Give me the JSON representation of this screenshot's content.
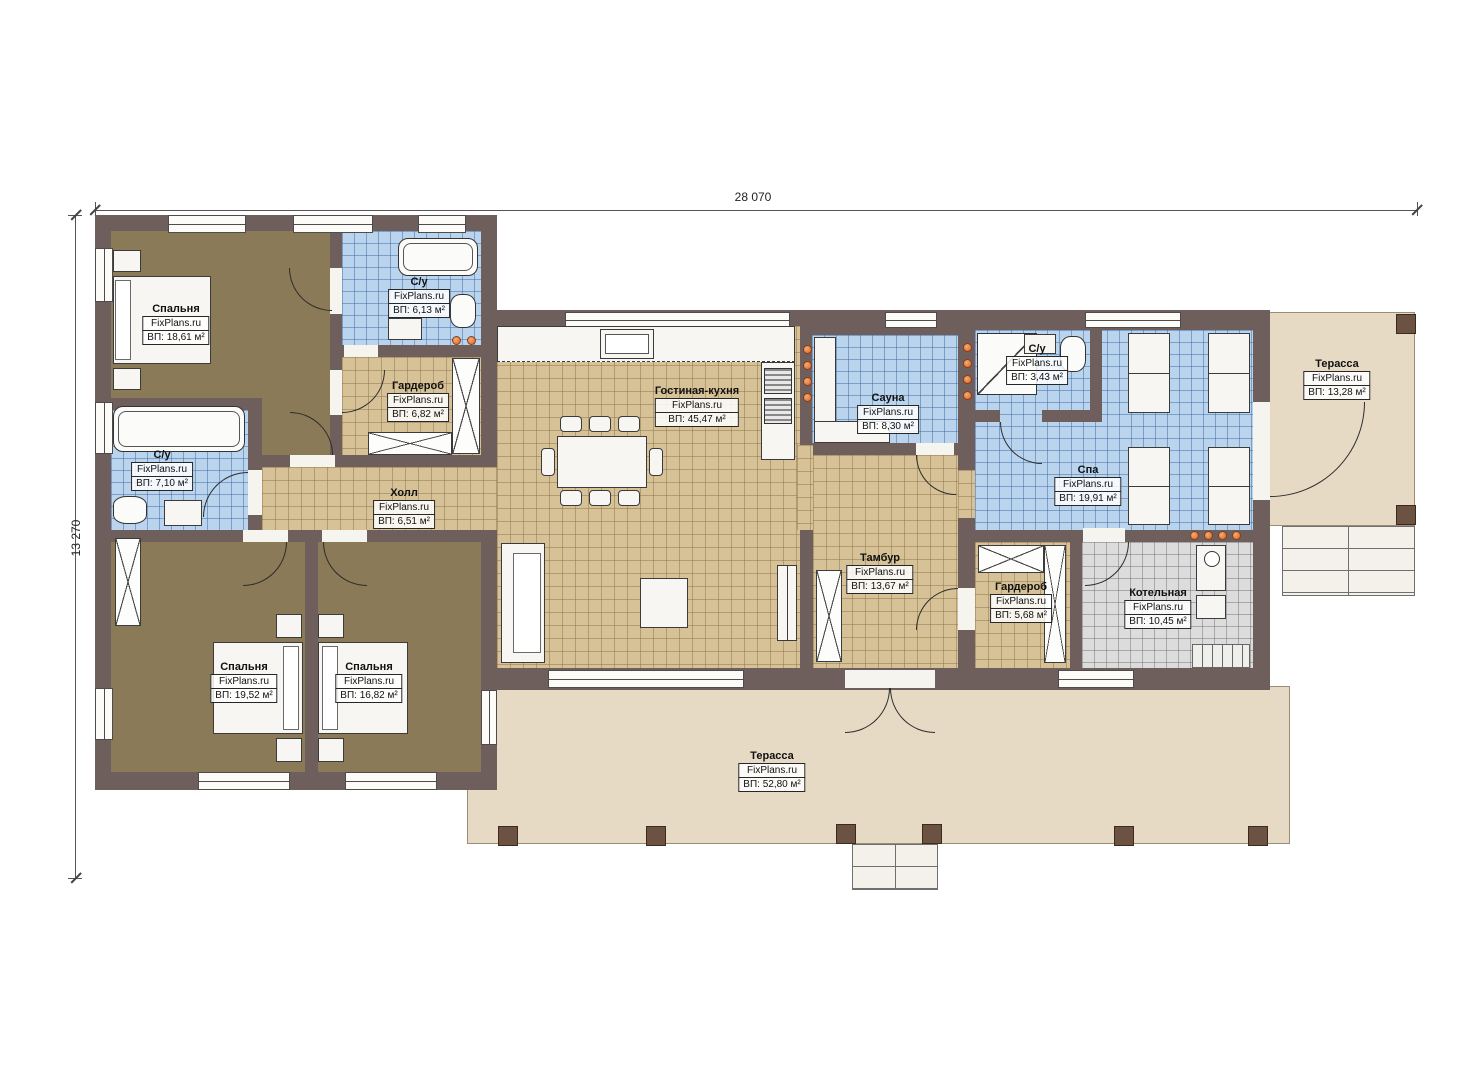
{
  "dimensions": {
    "top": "28 070",
    "left": "13 270"
  },
  "watermark": "FixPlans.ru",
  "rooms": {
    "bedroom1": {
      "name": "Спальня",
      "area": "ВП: 18,61 м²"
    },
    "bath1": {
      "name": "С/у",
      "area": "ВП: 6,13 м²"
    },
    "wardrobe1": {
      "name": "Гардероб",
      "area": "ВП: 6,82 м²"
    },
    "bath2": {
      "name": "С/у",
      "area": "ВП: 7,10 м²"
    },
    "hall": {
      "name": "Холл",
      "area": "ВП: 6,51 м²"
    },
    "living": {
      "name": "Гостиная-кухня",
      "area": "ВП: 45,47 м²"
    },
    "sauna": {
      "name": "Сауна",
      "area": "ВП: 8,30 м²"
    },
    "vestibule": {
      "name": "Тамбур",
      "area": "ВП: 13,67 м²"
    },
    "bath3": {
      "name": "С/у",
      "area": "ВП: 3,43 м²"
    },
    "spa": {
      "name": "Спа",
      "area": "ВП: 19,91 м²"
    },
    "terrace_right": {
      "name": "Терасса",
      "area": "ВП: 13,28 м²"
    },
    "wardrobe2": {
      "name": "Гардероб",
      "area": "ВП: 5,68 м²"
    },
    "boiler": {
      "name": "Котельная",
      "area": "ВП: 10,45 м²"
    },
    "bedroom2": {
      "name": "Спальня",
      "area": "ВП: 19,52 м²"
    },
    "bedroom3": {
      "name": "Спальня",
      "area": "ВП: 16,82 м²"
    },
    "terrace_main": {
      "name": "Терасса",
      "area": "ВП: 52,80 м²"
    }
  },
  "colors": {
    "wall": "#6e5f5c",
    "floor_wood": "#8b7a57",
    "tile_tan": "#d7c298",
    "tile_blue": "#bad4ee",
    "tile_gray": "#dcdcdc",
    "terrace": "#e6dac5",
    "accent_dot": "#d9622b"
  }
}
